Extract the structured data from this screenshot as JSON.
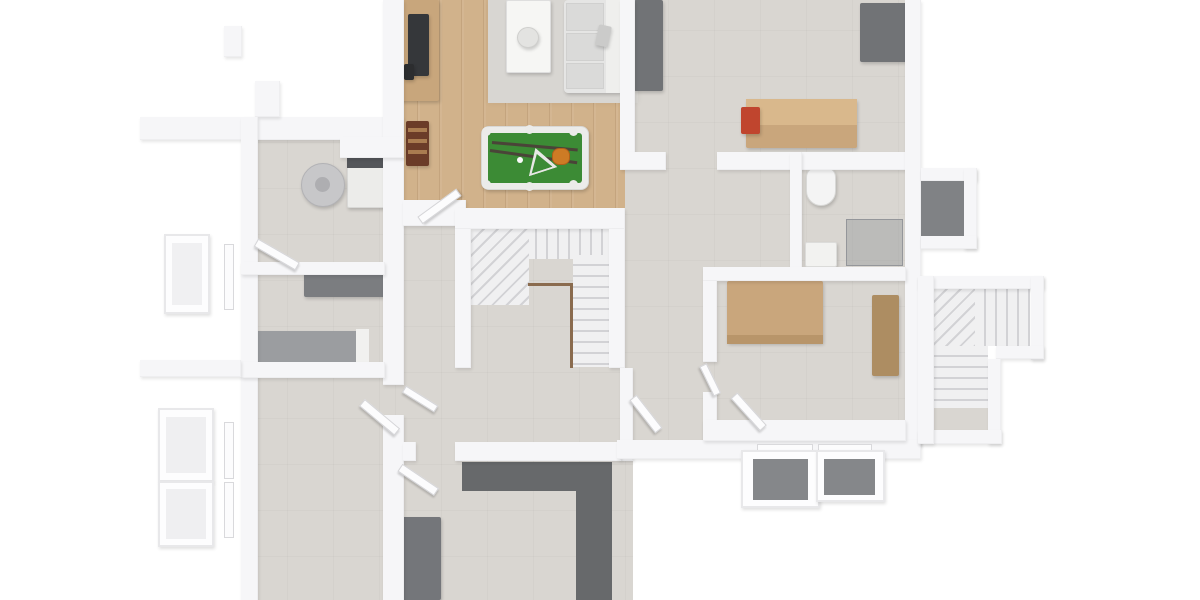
{
  "palette": {
    "wall": "#f6f6f8",
    "concrete": "#d9d6d1",
    "wood": "#d1b28b",
    "rug": "#d8d6d2",
    "felt": "#3c8b35",
    "frame": "#ececea",
    "sofa": "#e5e5e4",
    "cushion": "#dadad9",
    "sofaBack": "#efefed",
    "darkGray": "#717376",
    "darkerGray": "#67696b",
    "tan": "#c9a67c",
    "tanDark": "#b8956a",
    "wardrobe": "#ad8d62",
    "grayBed": "#9b9da0",
    "toilet": "#f4f4f4",
    "red": "#c0452e",
    "brown": "#6b3c28",
    "railing": "#8a6b4e",
    "wellDark": "#85878a",
    "tvDark": "#35373a",
    "washerPanel": "#54565a",
    "boiler": "#c7c7c9",
    "boilerHub": "#aeaeb1",
    "desk": "#7b7d80",
    "cueDark": "#4a4438",
    "ballOrange": "#cd7b25",
    "annexFloor": "#808285",
    "glassFill": "rgba(140,144,148,0.38)",
    "stairLight": "#f0f0f1",
    "stairLine": "#d2d2d5"
  },
  "elements": [
    {
      "n": "floor-left-wing",
      "t": "floor-concrete",
      "r": [
        241,
        117,
        162,
        486
      ]
    },
    {
      "n": "floor-center",
      "t": "floor-concrete",
      "r": [
        395,
        200,
        238,
        403
      ]
    },
    {
      "n": "floor-right-wing",
      "t": "floor-concrete",
      "r": [
        622,
        0,
        290,
        445
      ]
    },
    {
      "n": "floor-game-room-wood",
      "t": "floor-wood",
      "r": [
        395,
        0,
        230,
        222
      ]
    },
    {
      "n": "living-area-rug",
      "t": "rug",
      "r": [
        488,
        0,
        150,
        103
      ]
    },
    {
      "n": "tv-sideboard",
      "t": "furn",
      "r": [
        396,
        0,
        43,
        101
      ],
      "bg": "#c8a67c"
    },
    {
      "n": "tv",
      "t": "furn",
      "r": [
        408,
        14,
        21,
        62
      ],
      "bg": "tvDark"
    },
    {
      "n": "tv-accessory",
      "t": "furn",
      "r": [
        404,
        64,
        10,
        16
      ],
      "bg": "#2c2d2f"
    },
    {
      "n": "foosball-table",
      "t": "furn",
      "r": [
        406,
        121,
        23,
        45
      ],
      "bg": "brown"
    },
    {
      "n": "foosball-rod-1",
      "t": "flat",
      "r": [
        408,
        128,
        19,
        4
      ],
      "bg": "#a97c50"
    },
    {
      "n": "foosball-rod-2",
      "t": "flat",
      "r": [
        408,
        139,
        19,
        4
      ],
      "bg": "#a97c50"
    },
    {
      "n": "foosball-rod-3",
      "t": "flat",
      "r": [
        408,
        150,
        19,
        4
      ],
      "bg": "#a97c50"
    },
    {
      "n": "coffee-table",
      "t": "furn",
      "r": [
        506,
        0,
        45,
        73
      ],
      "bg": "#f6f6f4",
      "bd": "1px solid #dedede"
    },
    {
      "n": "decor-bowl",
      "t": "furn circle",
      "r": [
        517,
        27,
        22,
        21
      ],
      "bg": "#e3e3e1",
      "bd": "1px solid #cfcfcd"
    },
    {
      "n": "sofa-base",
      "t": "furn",
      "r": [
        564,
        0,
        58,
        93
      ],
      "bg": "sofa",
      "rad": "4px"
    },
    {
      "n": "sofa-backrest",
      "t": "flat",
      "r": [
        606,
        0,
        16,
        93
      ],
      "bg": "sofaBack"
    },
    {
      "n": "sofa-cushion-1",
      "t": "flat",
      "r": [
        566,
        3,
        38,
        28
      ],
      "bg": "cushion",
      "bd": "1px solid #d0d0cf"
    },
    {
      "n": "sofa-cushion-2",
      "t": "flat",
      "r": [
        566,
        33,
        38,
        28
      ],
      "bg": "cushion",
      "bd": "1px solid #d0d0cf"
    },
    {
      "n": "sofa-cushion-3",
      "t": "flat",
      "r": [
        566,
        63,
        38,
        26
      ],
      "bg": "cushion",
      "bd": "1px solid #d0d0cf"
    },
    {
      "n": "sofa-pillow",
      "t": "furn",
      "r": [
        597,
        24,
        13,
        21
      ],
      "bg": "#cbcbca",
      "rot": 12
    },
    {
      "n": "pool-table-frame",
      "t": "furn",
      "r": [
        481,
        126,
        108,
        64
      ],
      "bg": "frame",
      "bd": "1px solid #d8d8d6",
      "rad": "8px"
    },
    {
      "n": "pool-table-felt",
      "t": "flat",
      "r": [
        488,
        133,
        94,
        50
      ],
      "bg": "felt",
      "rad": "3px"
    },
    {
      "n": "pool-pocket-tl",
      "t": "flat circle",
      "r": [
        482,
        127,
        9,
        9
      ],
      "bg": "#ebebe9"
    },
    {
      "n": "pool-pocket-tr",
      "t": "flat circle",
      "r": [
        569,
        127,
        9,
        9
      ],
      "bg": "#ebebe9"
    },
    {
      "n": "pool-pocket-bl",
      "t": "flat circle",
      "r": [
        482,
        180,
        9,
        9
      ],
      "bg": "#ebebe9"
    },
    {
      "n": "pool-pocket-br",
      "t": "flat circle",
      "r": [
        569,
        180,
        9,
        9
      ],
      "bg": "#ebebe9"
    },
    {
      "n": "pool-pocket-tm",
      "t": "flat circle",
      "r": [
        525,
        125,
        9,
        9
      ],
      "bg": "#ebebe9"
    },
    {
      "n": "pool-pocket-bm",
      "t": "flat circle",
      "r": [
        525,
        182,
        9,
        9
      ],
      "bg": "#ebebe9"
    },
    {
      "n": "pool-cue-1",
      "t": "flat",
      "r": [
        492,
        141,
        86,
        3
      ],
      "bg": "cueDark",
      "rot": 5
    },
    {
      "n": "pool-cue-2",
      "t": "flat",
      "r": [
        490,
        149,
        88,
        3
      ],
      "bg": "cueDark",
      "rot": 8
    },
    {
      "n": "cue-ball",
      "t": "flat circle",
      "r": [
        517,
        157,
        6,
        6
      ],
      "bg": "#fafafa"
    },
    {
      "n": "pool-ball-cluster",
      "t": "flat",
      "r": [
        552,
        148,
        18,
        17
      ],
      "bg": "ballOrange",
      "bd": "1px solid #b06018",
      "rad": "40%"
    },
    {
      "n": "pool-rack-triangle-outer",
      "t": "tri",
      "r": [
        525,
        152,
        30,
        25
      ],
      "bg": "#e8e8e6",
      "rot": -18
    },
    {
      "n": "pool-rack-triangle-inner",
      "t": "tri",
      "r": [
        529,
        157,
        22,
        17
      ],
      "bg": "felt",
      "rot": -18
    },
    {
      "n": "workshop-cabinet-left",
      "t": "furn",
      "r": [
        634,
        0,
        29,
        91
      ],
      "bg": "darkGray"
    },
    {
      "n": "workshop-cabinet-right",
      "t": "furn",
      "r": [
        860,
        3,
        48,
        59
      ],
      "bg": "darkGray"
    },
    {
      "n": "workbench",
      "t": "furn",
      "r": [
        746,
        99,
        111,
        49
      ],
      "bg": "tan"
    },
    {
      "n": "workbench-top",
      "t": "flat",
      "r": [
        746,
        99,
        111,
        26
      ],
      "bg": "#d9b88c"
    },
    {
      "n": "bench-vise",
      "t": "furn",
      "r": [
        741,
        107,
        19,
        27
      ],
      "bg": "red"
    },
    {
      "n": "washing-machine",
      "t": "furn",
      "r": [
        347,
        157,
        44,
        51
      ],
      "bg": "#ececea",
      "bd": "1px solid #d8d8d6"
    },
    {
      "n": "washer-control-panel",
      "t": "flat",
      "r": [
        347,
        157,
        44,
        11
      ],
      "bg": "washerPanel"
    },
    {
      "n": "water-heater",
      "t": "furn circle",
      "r": [
        301,
        163,
        44,
        44
      ],
      "bg": "boiler",
      "bd": "1px solid #b2b2b5"
    },
    {
      "n": "water-heater-hub",
      "t": "flat circle",
      "r": [
        315,
        177,
        15,
        15
      ],
      "bg": "boilerHub"
    },
    {
      "n": "gray-desk",
      "t": "furn",
      "r": [
        304,
        270,
        86,
        27
      ],
      "bg": "desk"
    },
    {
      "n": "daybed",
      "t": "furn",
      "r": [
        245,
        331,
        114,
        33
      ],
      "bg": "grayBed"
    },
    {
      "n": "daybed-frame-end",
      "t": "flat",
      "r": [
        356,
        329,
        13,
        36
      ],
      "bg": "#f1f1ef"
    },
    {
      "n": "double-bed",
      "t": "furn",
      "r": [
        727,
        281,
        96,
        62
      ],
      "bg": "tan"
    },
    {
      "n": "bed-foot-band",
      "t": "flat",
      "r": [
        727,
        335,
        96,
        9
      ],
      "bg": "tanDark"
    },
    {
      "n": "wardrobe",
      "t": "furn",
      "r": [
        872,
        295,
        27,
        81
      ],
      "bg": "wardrobe"
    },
    {
      "n": "toilet",
      "t": "furn",
      "r": [
        806,
        167,
        30,
        39
      ],
      "bg": "toilet",
      "bd": "1px solid #d8d8d6",
      "rad": "10px 10px 15px 15px"
    },
    {
      "n": "shower-tray",
      "t": "furn",
      "r": [
        805,
        242,
        32,
        25
      ],
      "bg": "#f2f2f0",
      "bd": "1px solid #dcdcda"
    },
    {
      "n": "shower-glass",
      "t": "flat",
      "r": [
        846,
        219,
        57,
        47
      ],
      "bg": "glassFill",
      "bd": "1px solid #94969a"
    },
    {
      "n": "dark-counter-top-band",
      "t": "flat",
      "r": [
        462,
        462,
        150,
        29
      ],
      "bg": "darkerGray"
    },
    {
      "n": "dark-counter-right-band",
      "t": "flat",
      "r": [
        576,
        491,
        36,
        109
      ],
      "bg": "darkerGray"
    },
    {
      "n": "dark-cabinet",
      "t": "furn",
      "r": [
        402,
        517,
        39,
        83
      ],
      "bg": "#74767a"
    },
    {
      "n": "main-stair-top-flight",
      "t": "stair-v",
      "r": [
        471,
        229,
        138,
        30
      ]
    },
    {
      "n": "main-stair-winders",
      "t": "stair-diag",
      "r": [
        471,
        229,
        58,
        76
      ]
    },
    {
      "n": "main-stair-down-flight",
      "t": "stair-h",
      "r": [
        573,
        255,
        36,
        112
      ]
    },
    {
      "n": "right-stair-winders",
      "t": "stair-diag",
      "r": [
        934,
        289,
        42,
        57
      ]
    },
    {
      "n": "right-stair-upper-flight",
      "t": "stair-v",
      "r": [
        975,
        289,
        55,
        57
      ]
    },
    {
      "n": "right-stair-down-flight",
      "t": "stair-h",
      "r": [
        934,
        346,
        54,
        62
      ]
    },
    {
      "n": "right-stair-landing",
      "t": "flat",
      "r": [
        934,
        408,
        54,
        22
      ],
      "bg": "concrete"
    },
    {
      "n": "wall-top-left-long",
      "t": "wall",
      "r": [
        140,
        117,
        263,
        23
      ]
    },
    {
      "n": "wall-stub-up",
      "t": "wall",
      "r": [
        255,
        81,
        25,
        36
      ]
    },
    {
      "n": "wall-pillar-topleft",
      "t": "wall",
      "r": [
        224,
        26,
        18,
        31
      ]
    },
    {
      "n": "wall-left-exterior",
      "t": "wall",
      "r": [
        241,
        117,
        17,
        486
      ]
    },
    {
      "n": "wall-center-left-upper",
      "t": "wall",
      "r": [
        383,
        0,
        21,
        385
      ]
    },
    {
      "n": "wall-center-left-lower",
      "t": "wall",
      "r": [
        383,
        415,
        21,
        188
      ]
    },
    {
      "n": "wall-divider-utility",
      "t": "wall",
      "r": [
        241,
        262,
        144,
        13
      ]
    },
    {
      "n": "wall-divider-daybed-room",
      "t": "wall",
      "r": [
        241,
        362,
        144,
        16
      ]
    },
    {
      "n": "wall-stub-left-mid",
      "t": "wall",
      "r": [
        140,
        360,
        101,
        17
      ]
    },
    {
      "n": "wall-game-room-bottom",
      "t": "wall",
      "r": [
        403,
        200,
        63,
        26
      ]
    },
    {
      "n": "wall-stairwell-top",
      "t": "wall",
      "r": [
        455,
        208,
        170,
        21
      ]
    },
    {
      "n": "wall-stairwell-left",
      "t": "wall",
      "r": [
        455,
        229,
        16,
        139
      ]
    },
    {
      "n": "wall-stairwell-right",
      "t": "wall",
      "r": [
        609,
        229,
        16,
        139
      ]
    },
    {
      "n": "wall-game-workshop-divider",
      "t": "wall",
      "r": [
        620,
        0,
        15,
        153
      ]
    },
    {
      "n": "wall-workshop-bottom-left",
      "t": "wall",
      "r": [
        620,
        152,
        46,
        18
      ]
    },
    {
      "n": "wall-workshop-bottom-right",
      "t": "wall",
      "r": [
        717,
        152,
        196,
        18
      ]
    },
    {
      "n": "wall-right-exterior",
      "t": "wall",
      "r": [
        905,
        0,
        16,
        446
      ]
    },
    {
      "n": "wall-bath-divider",
      "t": "wall",
      "r": [
        790,
        152,
        12,
        117
      ]
    },
    {
      "n": "wall-bedroom-top",
      "t": "wall",
      "r": [
        703,
        267,
        203,
        14
      ]
    },
    {
      "n": "wall-bedroom-left-upper",
      "t": "wall",
      "r": [
        703,
        281,
        14,
        81
      ]
    },
    {
      "n": "wall-bedroom-left-lower",
      "t": "wall",
      "r": [
        703,
        392,
        14,
        52
      ]
    },
    {
      "n": "wall-corridor-left",
      "t": "wall",
      "r": [
        620,
        368,
        13,
        93
      ]
    },
    {
      "n": "wall-hall-bottom-a",
      "t": "wall",
      "r": [
        403,
        442,
        13,
        19
      ]
    },
    {
      "n": "wall-hall-bottom-b",
      "t": "wall",
      "r": [
        455,
        442,
        166,
        19
      ]
    },
    {
      "n": "wall-bottom-right-exterior",
      "t": "wall",
      "r": [
        617,
        440,
        304,
        19
      ]
    },
    {
      "n": "wall-bedroom-bottom",
      "t": "wall",
      "r": [
        703,
        420,
        203,
        21
      ]
    },
    {
      "n": "wall-utility-counter",
      "t": "wall",
      "r": [
        340,
        137,
        64,
        21
      ]
    },
    {
      "n": "wall-annex-top",
      "t": "wall",
      "r": [
        921,
        168,
        56,
        13
      ]
    },
    {
      "n": "wall-annex-right",
      "t": "wall",
      "r": [
        964,
        168,
        13,
        81
      ]
    },
    {
      "n": "wall-annex-bottom",
      "t": "wall",
      "r": [
        921,
        236,
        56,
        13
      ]
    },
    {
      "n": "wall-right-stair-top",
      "t": "wall",
      "r": [
        918,
        276,
        126,
        13
      ]
    },
    {
      "n": "wall-right-stair-right-upper",
      "t": "wall",
      "r": [
        1031,
        276,
        13,
        84
      ]
    },
    {
      "n": "wall-right-stair-mid",
      "t": "wall",
      "r": [
        996,
        346,
        48,
        13
      ]
    },
    {
      "n": "wall-right-stair-right-lower",
      "t": "wall",
      "r": [
        988,
        359,
        13,
        85
      ]
    },
    {
      "n": "wall-right-stair-bottom",
      "t": "wall",
      "r": [
        918,
        430,
        84,
        14
      ]
    },
    {
      "n": "wall-right-stair-left",
      "t": "wall",
      "r": [
        918,
        276,
        16,
        168
      ]
    },
    {
      "n": "annex-shaft-floor",
      "t": "flat",
      "r": [
        921,
        181,
        43,
        55
      ],
      "bg": "annexFloor"
    },
    {
      "n": "window-left-upper",
      "t": "window",
      "r": [
        224,
        244,
        10,
        66
      ]
    },
    {
      "n": "window-left-mid",
      "t": "window",
      "r": [
        224,
        422,
        10,
        57
      ]
    },
    {
      "n": "window-left-lower",
      "t": "window",
      "r": [
        224,
        482,
        10,
        56
      ]
    },
    {
      "n": "window-bottom-right-1",
      "t": "window",
      "r": [
        757,
        444,
        56,
        9
      ]
    },
    {
      "n": "window-bottom-right-2",
      "t": "window",
      "r": [
        818,
        444,
        54,
        9
      ]
    },
    {
      "n": "window-well-left-1",
      "t": "well",
      "r": [
        164,
        234,
        46,
        80
      ]
    },
    {
      "n": "window-well-left-1-inner",
      "t": "flat",
      "r": [
        172,
        243,
        30,
        62
      ],
      "bg": "#f0f0f2"
    },
    {
      "n": "window-well-left-2",
      "t": "well",
      "r": [
        158,
        408,
        56,
        74
      ]
    },
    {
      "n": "window-well-left-2-inner",
      "t": "flat",
      "r": [
        166,
        417,
        40,
        56
      ],
      "bg": "#efeff1"
    },
    {
      "n": "window-well-left-3",
      "t": "well",
      "r": [
        158,
        481,
        56,
        66
      ]
    },
    {
      "n": "window-well-left-3-inner",
      "t": "flat",
      "r": [
        166,
        489,
        40,
        50
      ],
      "bg": "#efeff1"
    },
    {
      "n": "window-well-bottom-1",
      "t": "well",
      "r": [
        741,
        450,
        79,
        58
      ]
    },
    {
      "n": "window-well-bottom-1-inner",
      "t": "flat",
      "r": [
        753,
        459,
        55,
        41
      ],
      "bg": "wellDark"
    },
    {
      "n": "window-well-bottom-2",
      "t": "well",
      "r": [
        816,
        450,
        69,
        52
      ]
    },
    {
      "n": "window-well-bottom-2-inner",
      "t": "flat",
      "r": [
        824,
        459,
        51,
        36
      ],
      "bg": "wellDark"
    },
    {
      "n": "door-utility-room",
      "t": "door-leaf",
      "r": [
        256,
        238,
        48,
        9
      ],
      "rot": 30
    },
    {
      "n": "door-game-room",
      "t": "door-leaf",
      "r": [
        420,
        216,
        48,
        9
      ],
      "rot": -36
    },
    {
      "n": "door-bottom-left-room",
      "t": "door-leaf",
      "r": [
        362,
        398,
        46,
        9
      ],
      "rot": 40
    },
    {
      "n": "door-hall",
      "t": "door-leaf",
      "r": [
        404,
        385,
        38,
        8
      ],
      "rot": 32
    },
    {
      "n": "door-corridor-left",
      "t": "door-leaf",
      "r": [
        633,
        393,
        42,
        9
      ],
      "rot": 52
    },
    {
      "n": "door-corridor-right",
      "t": "door-leaf",
      "r": [
        734,
        391,
        44,
        9
      ],
      "rot": 48
    },
    {
      "n": "door-bedroom",
      "t": "door-leaf",
      "r": [
        703,
        361,
        33,
        8
      ],
      "rot": 64
    },
    {
      "n": "door-dark-room",
      "t": "door-leaf",
      "r": [
        400,
        463,
        44,
        9
      ],
      "rot": 34
    },
    {
      "n": "stair-railing-horizontal",
      "t": "flat",
      "r": [
        528,
        283,
        45,
        3
      ],
      "bg": "railing"
    },
    {
      "n": "stair-railing-vertical",
      "t": "flat",
      "r": [
        570,
        283,
        3,
        85
      ],
      "bg": "railing"
    }
  ]
}
